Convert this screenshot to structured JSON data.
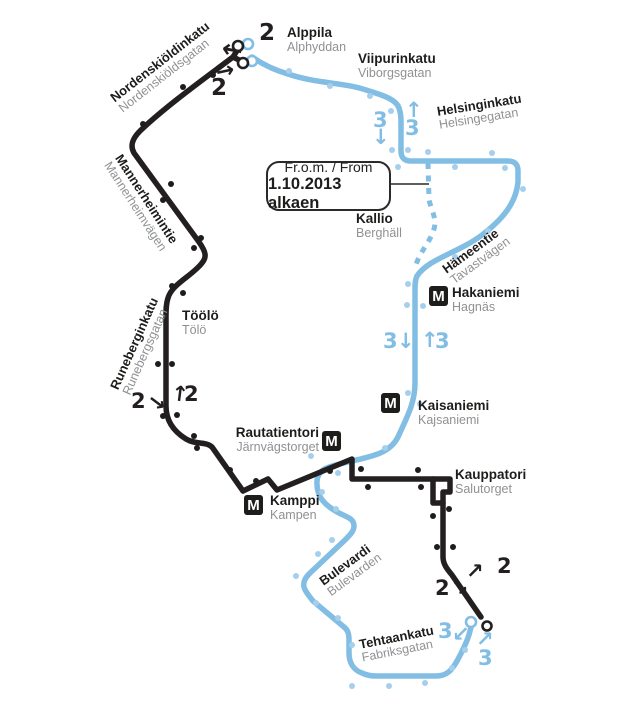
{
  "colors": {
    "route2": "#231f20",
    "route3": "#82bde4",
    "stop2": "#1d1d1b",
    "stop3": "#a5cfec",
    "swedish": "#8f9193",
    "text": "#1d1d1b",
    "callout_border": "#2a2a2a",
    "background": "#ffffff"
  },
  "metro_letter": "M",
  "callout": {
    "line1": "Fr.o.m. / From",
    "line2": "1.10.2013 alkaen"
  },
  "routes": {
    "route2": {
      "number": "2",
      "d": "M 238 49 L 233 57 L 243 62 M 233 57 C 208 76 166 106 140 131 C 132 139 130 146 134 153 L 199 242 C 206 252 207 257 202 263 C 192 276 172 284 168 298 C 166 304 166 310 166 316 L 166 406 C 166 420 173 431 186 439 C 196 445 205 441 212 447 L 243 491 L 268 479 L 277 490 L 352 459 L 352 479 L 450 479 L 450 492 L 443 492 L 443 557 C 443 564 447 569 452 575 L 481 617"
    },
    "route2_loop": {
      "d": "M 433 479 L 433 503 L 443 503"
    },
    "route3": {
      "number": "3",
      "d": "M 252 57 C 262 64 274 70 288 74 C 318 84 342 82 366 90 C 382 95 396 99 399 108 C 401 114 401 118 401 124 L 401 151 Q 401 161 411 161 L 508 161 Q 518 161 518 171 L 518 182 C 516 203 503 219 482 235 C 458 253 428 259 417 276 C 415 280 415 285 415 290 L 415 383 C 415 403 407 417 398 437 C 390 453 373 456 352 461 C 332 466 318 467 317 481 C 316 497 325 506 341 514 C 350 518 354 520 354 526 C 354 531 350 535 345 540 L 310 573 C 305 578 303 582 304 587 C 305 591 309 596 313 601 L 344 627 C 348 630 349 634 349 640 L 349 653 C 349 662 353 670 362 673 C 366 675 370 676 376 676 L 436 676 C 447 676 452 670 457 661 C 463 650 468 640 470 631 C 471 628 471 626 471 625"
    },
    "route3_discontinued": {
      "d": "M 428 163 L 429 200 C 432 212 437 219 434 229 C 430 243 419 252 415 268"
    },
    "callout_connector": {
      "d": "M 387 184 L 429 184"
    }
  },
  "stations": [
    {
      "name": "Alppila",
      "name_sv": "Alphyddan",
      "x": 287,
      "y": 26,
      "align": "left"
    },
    {
      "name": "Viipurinkatu",
      "name_sv": "Viborgsgatan",
      "x": 358,
      "y": 52,
      "align": "left"
    },
    {
      "name": "Kallio",
      "name_sv": "Berghäll",
      "x": 356,
      "y": 212,
      "align": "left"
    },
    {
      "name": "Hakaniemi",
      "name_sv": "Hagnäs",
      "x": 452,
      "y": 286,
      "align": "left",
      "m": {
        "x": 429,
        "y": 286
      }
    },
    {
      "name": "Töölö",
      "name_sv": "Tölö",
      "x": 182,
      "y": 309,
      "align": "left"
    },
    {
      "name": "Kaisaniemi",
      "name_sv": "Kajsaniemi",
      "x": 418,
      "y": 399,
      "align": "left",
      "m": {
        "x": 381,
        "y": 393
      }
    },
    {
      "name": "Rautatientori",
      "name_sv": "Järnvägstorget",
      "x": 319,
      "y": 426,
      "align": "right",
      "m": {
        "x": 322,
        "y": 431
      }
    },
    {
      "name": "Kamppi",
      "name_sv": "Kampen",
      "x": 270,
      "y": 494,
      "align": "left",
      "m": {
        "x": 244,
        "y": 495
      }
    },
    {
      "name": "Kauppatori",
      "name_sv": "Salutorget",
      "x": 455,
      "y": 468,
      "align": "left"
    }
  ],
  "streets": [
    {
      "name": "Nordenskiöldinkatu",
      "name_sv": "Nordenskiöldsgatan",
      "x": 108,
      "y": 94,
      "rotate": -38
    },
    {
      "name": "Mannerheimintie",
      "name_sv": "Mannerheimvägen",
      "x": 124,
      "y": 152,
      "rotate": 57
    },
    {
      "name": "Runeberginkatu",
      "name_sv": "Runebergsgatan",
      "x": 108,
      "y": 386,
      "rotate": -66
    },
    {
      "name": "Helsinginkatu",
      "name_sv": "Helsingegatan",
      "x": 436,
      "y": 105,
      "rotate": -9
    },
    {
      "name": "Hämeentie",
      "name_sv": "Tavastvägen",
      "x": 440,
      "y": 265,
      "rotate": -36
    },
    {
      "name": "Bulevardi",
      "name_sv": "Bulevarden",
      "x": 317,
      "y": 577,
      "rotate": -36
    },
    {
      "name": "Tehtaankatu",
      "name_sv": "Fabriksgatan",
      "x": 358,
      "y": 638,
      "rotate": -11
    }
  ],
  "markers": [
    {
      "label": "2",
      "route": "2",
      "x": 259,
      "y": 22,
      "size": 23
    },
    {
      "arrow": "←",
      "route": "2",
      "x": 222,
      "y": 37,
      "size": 25,
      "rotate": 10
    },
    {
      "arrow": "→",
      "route": "2",
      "x": 216,
      "y": 61,
      "size": 22,
      "rotate": -12
    },
    {
      "label": "2",
      "route": "2",
      "x": 211,
      "y": 77,
      "size": 23
    },
    {
      "label": "3",
      "route": "3",
      "x": 373,
      "y": 110
    },
    {
      "arrow": "↓",
      "route": "3",
      "x": 372,
      "y": 127
    },
    {
      "arrow": "↑",
      "route": "3",
      "x": 405,
      "y": 100
    },
    {
      "label": "3",
      "route": "3",
      "x": 405,
      "y": 118
    },
    {
      "label": "2",
      "route": "2",
      "x": 131,
      "y": 391
    },
    {
      "arrow": "↘",
      "route": "2",
      "x": 148,
      "y": 393,
      "rotate": -8
    },
    {
      "arrow": "↑",
      "route": "2",
      "x": 171,
      "y": 384,
      "rotate": 7
    },
    {
      "label": "2",
      "route": "2",
      "x": 184,
      "y": 384
    },
    {
      "label": "3",
      "route": "3",
      "x": 383,
      "y": 331
    },
    {
      "arrow": "↓",
      "route": "3",
      "x": 397,
      "y": 331
    },
    {
      "arrow": "↑",
      "route": "3",
      "x": 421,
      "y": 330
    },
    {
      "label": "3",
      "route": "3",
      "x": 435,
      "y": 331
    },
    {
      "label": "2",
      "route": "2",
      "x": 435,
      "y": 578
    },
    {
      "arrow": "↘",
      "route": "2",
      "x": 451,
      "y": 578
    },
    {
      "arrow": "↗",
      "route": "2",
      "x": 466,
      "y": 561
    },
    {
      "label": "2",
      "route": "2",
      "x": 497,
      "y": 556
    },
    {
      "label": "3",
      "route": "3",
      "x": 438,
      "y": 621
    },
    {
      "arrow": "↙",
      "route": "3",
      "x": 452,
      "y": 624
    },
    {
      "arrow": "↗",
      "route": "3",
      "x": 476,
      "y": 629
    },
    {
      "label": "3",
      "route": "3",
      "x": 478,
      "y": 648
    }
  ],
  "stops": {
    "route2": [
      [
        213,
        75
      ],
      [
        183,
        87
      ],
      [
        143,
        124
      ],
      [
        171,
        184
      ],
      [
        163,
        200
      ],
      [
        201,
        238
      ],
      [
        194,
        248
      ],
      [
        172,
        286
      ],
      [
        183,
        293
      ],
      [
        158,
        364
      ],
      [
        172,
        364
      ],
      [
        163,
        416
      ],
      [
        177,
        415
      ],
      [
        194,
        436
      ],
      [
        197,
        448
      ],
      [
        230,
        470
      ],
      [
        256,
        481
      ],
      [
        330,
        471
      ],
      [
        361,
        469
      ],
      [
        368,
        487
      ],
      [
        418,
        470
      ],
      [
        421,
        487
      ],
      [
        449,
        509
      ],
      [
        433,
        516
      ],
      [
        437,
        547
      ],
      [
        453,
        547
      ]
    ],
    "route3": [
      [
        289,
        71
      ],
      [
        330,
        86
      ],
      [
        370,
        96
      ],
      [
        391,
        111
      ],
      [
        392,
        150
      ],
      [
        408,
        150
      ],
      [
        428,
        152
      ],
      [
        492,
        153
      ],
      [
        398,
        167
      ],
      [
        455,
        167
      ],
      [
        505,
        168
      ],
      [
        523,
        189
      ],
      [
        488,
        231
      ],
      [
        455,
        257
      ],
      [
        408,
        284
      ],
      [
        407,
        305
      ],
      [
        423,
        306
      ],
      [
        408,
        393
      ],
      [
        420,
        404
      ],
      [
        385,
        448
      ],
      [
        311,
        456
      ],
      [
        338,
        473
      ],
      [
        322,
        492
      ],
      [
        336,
        509
      ],
      [
        332,
        540
      ],
      [
        318,
        554
      ],
      [
        296,
        576
      ],
      [
        316,
        603
      ],
      [
        338,
        618
      ],
      [
        352,
        645
      ],
      [
        352,
        686
      ],
      [
        389,
        686
      ],
      [
        425,
        683
      ],
      [
        452,
        668
      ],
      [
        465,
        650
      ]
    ]
  },
  "terminals": [
    {
      "x": 248,
      "y": 44,
      "route": "3",
      "r": 5
    },
    {
      "x": 252,
      "y": 61,
      "route": "3",
      "r": 5
    },
    {
      "x": 238,
      "y": 46,
      "route": "2",
      "r": 5
    },
    {
      "x": 243,
      "y": 63,
      "route": "2",
      "r": 5
    },
    {
      "x": 471,
      "y": 622,
      "route": "3",
      "r": 5
    },
    {
      "x": 487,
      "y": 626,
      "route": "2",
      "r": 4.5
    }
  ]
}
